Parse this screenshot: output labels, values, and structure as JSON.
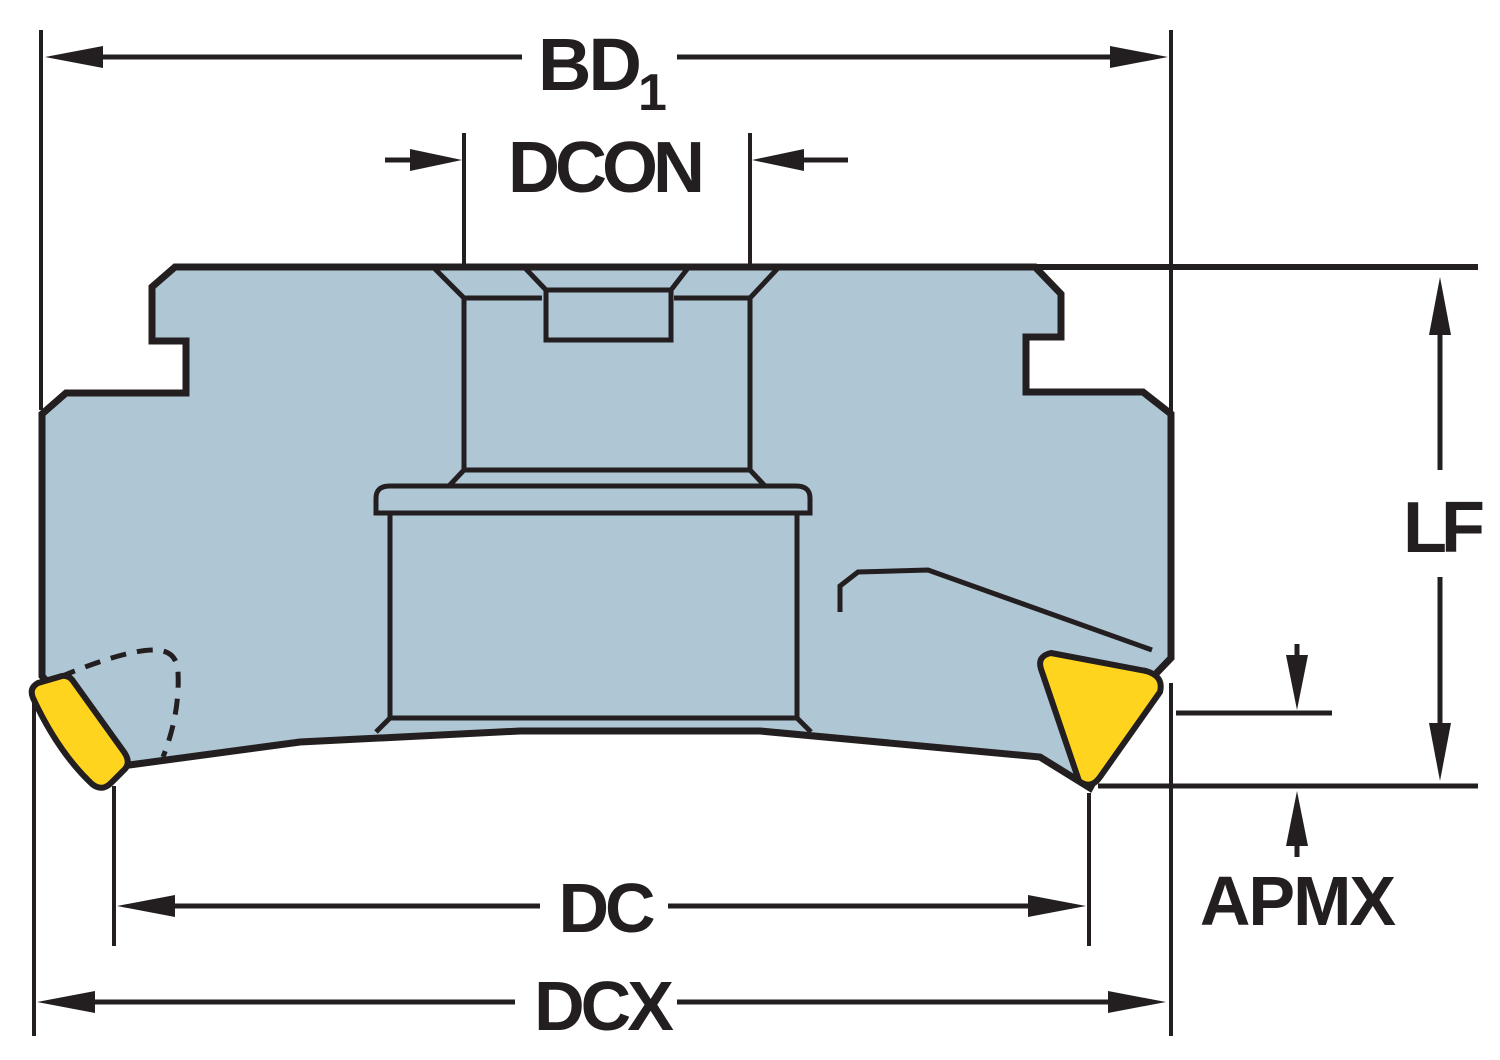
{
  "title": "Milling cutter side-view dimension drawing",
  "labels": {
    "bd1": {
      "main": "BD",
      "sub": "1"
    },
    "dcon": "DCON",
    "lf": "LF",
    "apmx": "APMX",
    "dc": "DC",
    "dcx": "DCX"
  },
  "colors": {
    "background": "#ffffff",
    "body": "#afc6d4",
    "insert": "#ffd41e",
    "line": "#231f20"
  }
}
